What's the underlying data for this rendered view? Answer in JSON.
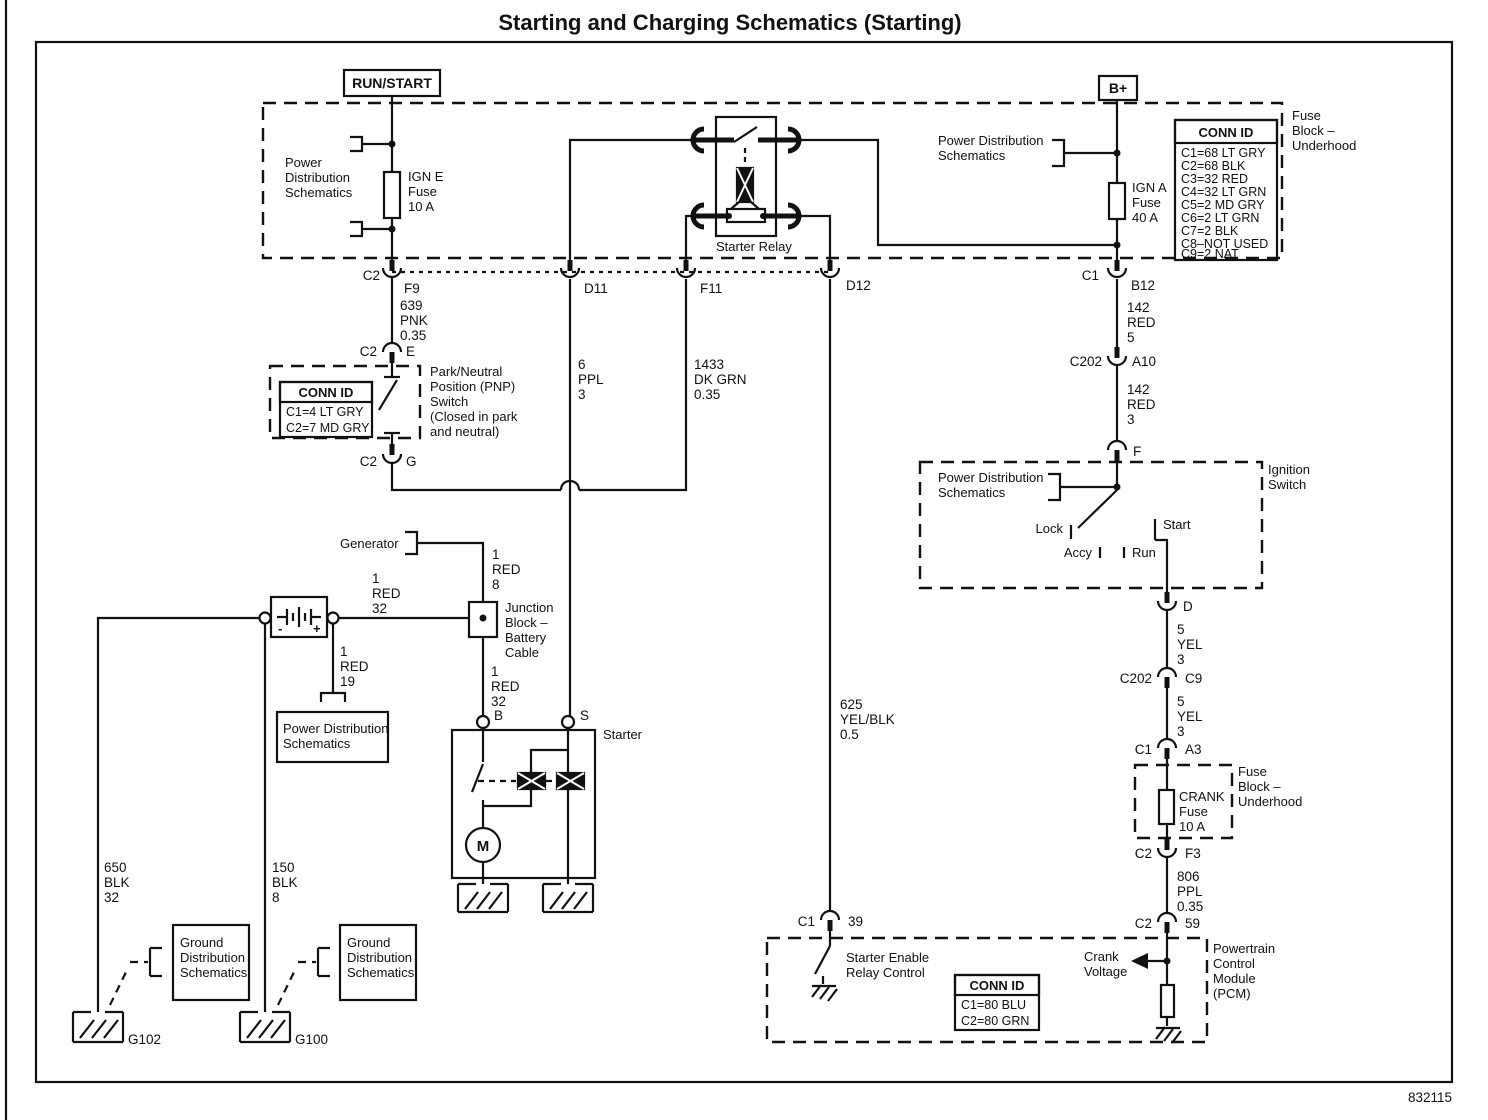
{
  "title": "Starting and Charging Schematics (Starting)",
  "doc_number": "832115",
  "terminals": {
    "run_start": "RUN/START",
    "b_plus": "B+"
  },
  "refs": {
    "pds_left": [
      "Power",
      "Distribution",
      "Schematics"
    ],
    "pds_top_right": [
      "Power Distribution",
      "Schematics"
    ],
    "pds_ignition": [
      "Power Distribution",
      "Schematics"
    ],
    "pds_battery": [
      "Power Distribution",
      "Schematics"
    ],
    "gds1": [
      "Ground",
      "Distribution",
      "Schematics"
    ],
    "gds2": [
      "Ground",
      "Distribution",
      "Schematics"
    ]
  },
  "components": {
    "ign_e_fuse": [
      "IGN E",
      "Fuse",
      "10 A"
    ],
    "ign_a_fuse": [
      "IGN A",
      "Fuse",
      "40 A"
    ],
    "crank_fuse": [
      "CRANK",
      "Fuse",
      "10 A"
    ],
    "fuse_block_top": [
      "Fuse",
      "Block –",
      "Underhood"
    ],
    "fuse_block_crank": [
      "Fuse",
      "Block –",
      "Underhood"
    ],
    "starter_relay": "Starter Relay",
    "starter": "Starter",
    "motor": "M",
    "generator": "Generator",
    "junction_block": [
      "Junction",
      "Block –",
      "Battery",
      "Cable"
    ],
    "pnp_switch": [
      "Park/Neutral",
      "Position (PNP)",
      "Switch",
      "(Closed in park",
      "and neutral)"
    ],
    "ignition_switch": [
      "Ignition",
      "Switch"
    ],
    "pcm": [
      "Powertrain",
      "Control",
      "Module",
      "(PCM)"
    ],
    "starter_enable": [
      "Starter Enable",
      "Relay Control"
    ],
    "crank_voltage": [
      "Crank",
      "Voltage"
    ]
  },
  "ignition_positions": {
    "lock": "Lock",
    "accy": "Accy",
    "run": "Run",
    "start": "Start"
  },
  "battery": {
    "neg": "-",
    "pos": "+"
  },
  "grounds": {
    "g102": "G102",
    "g100": "G100"
  },
  "wires": {
    "w639": [
      "639",
      "PNK",
      "0.35"
    ],
    "w6ppl": [
      "6",
      "PPL",
      "3"
    ],
    "w1433": [
      "1433",
      "DK GRN",
      "0.35"
    ],
    "w142a": [
      "142",
      "RED",
      "5"
    ],
    "w142b": [
      "142",
      "RED",
      "3"
    ],
    "w5yela": [
      "5",
      "YEL",
      "3"
    ],
    "w5yelb": [
      "5",
      "YEL",
      "3"
    ],
    "w806": [
      "806",
      "PPL",
      "0.35"
    ],
    "w625": [
      "625",
      "YEL/BLK",
      "0.5"
    ],
    "w650": [
      "650",
      "BLK",
      "32"
    ],
    "w150": [
      "150",
      "BLK",
      "8"
    ],
    "w1red8": [
      "1",
      "RED",
      "8"
    ],
    "w1red32a": [
      "1",
      "RED",
      "32"
    ],
    "w1red32b": [
      "1",
      "RED",
      "32"
    ],
    "w1red19": [
      "1",
      "RED",
      "19"
    ]
  },
  "connectors": {
    "f9": [
      "C2",
      "F9"
    ],
    "d11": [
      "D11"
    ],
    "f11": [
      "F11"
    ],
    "d12": [
      "D12"
    ],
    "b12": [
      "C1",
      "B12"
    ],
    "a10": [
      "C202",
      "A10"
    ],
    "f": [
      "F"
    ],
    "d": [
      "D"
    ],
    "c9": [
      "C202",
      "C9"
    ],
    "a3": [
      "C1",
      "A3"
    ],
    "f3": [
      "C2",
      "F3"
    ],
    "p59": [
      "C2",
      "59"
    ],
    "p39": [
      "C1",
      "39"
    ],
    "e": [
      "C2",
      "E"
    ],
    "g": [
      "C2",
      "G"
    ],
    "b": [
      "B"
    ],
    "s": [
      "S"
    ]
  },
  "conn_id_underhood": {
    "header": "CONN ID",
    "rows": [
      "C1=68 LT GRY",
      "C2=68 BLK",
      "C3=32 RED",
      "C4=32 LT GRN",
      "C5=2 MD GRY",
      "C6=2 LT GRN",
      "C7=2 BLK",
      "C8–NOT USED",
      "C9=2 NAT"
    ]
  },
  "conn_id_pnp": {
    "header": "CONN ID",
    "rows": [
      "C1=4 LT GRY",
      "C2=7 MD GRY"
    ]
  },
  "conn_id_pcm": {
    "header": "CONN ID",
    "rows": [
      "C1=80 BLU",
      "C2=80 GRN"
    ]
  }
}
